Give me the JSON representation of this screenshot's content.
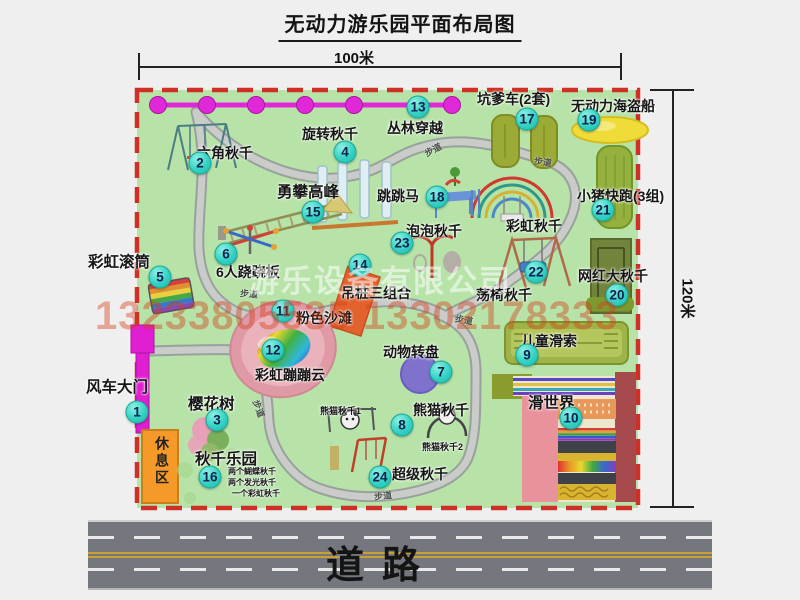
{
  "title": "无动力游乐园平面布局图",
  "dimensions": {
    "top": "100米",
    "right": "120米"
  },
  "watermark": {
    "company": "游乐设备有限公司",
    "phone": "13233805535 13302178333"
  },
  "road_label": "道路",
  "rest_area_label": "休息区",
  "path_label": "步道",
  "colors": {
    "map_green": "#b7e3a8",
    "dashed_border_red": "#cf3026",
    "badge_teal": "#34d2c4",
    "chain_magenta": "#e028d8",
    "gate_magenta": "#e01ed2",
    "rest_orange": "#f59a28",
    "road_gray": "#74777d",
    "watermark_red": "#d53e1a"
  },
  "attractions": [
    {
      "num": "1",
      "name": "风车大门"
    },
    {
      "num": "2",
      "name": "六角秋千"
    },
    {
      "num": "3",
      "name": "樱花树"
    },
    {
      "num": "4",
      "name": "旋转秋千"
    },
    {
      "num": "5",
      "name": "彩虹滚筒"
    },
    {
      "num": "6",
      "name": "6人跷跷板"
    },
    {
      "num": "7",
      "name": "动物转盘"
    },
    {
      "num": "8",
      "name": "熊猫秋千"
    },
    {
      "num": "9",
      "name": "儿童滑索"
    },
    {
      "num": "10",
      "name": "滑世界"
    },
    {
      "num": "11",
      "name": "粉色沙滩"
    },
    {
      "num": "12",
      "name": "彩虹蹦蹦云"
    },
    {
      "num": "13",
      "name": "丛林穿越"
    },
    {
      "num": "14",
      "name": "吊桩三组合"
    },
    {
      "num": "15",
      "name": "勇攀高峰"
    },
    {
      "num": "16",
      "name": "秋千乐园"
    },
    {
      "num": "17",
      "name": "坑爹车(2套)"
    },
    {
      "num": "18",
      "name": "跳跳马"
    },
    {
      "num": "19",
      "name": "无动力海盗船"
    },
    {
      "num": "20",
      "name": "网红大秋千"
    },
    {
      "num": "21",
      "name": "小猪快跑(3组)"
    },
    {
      "num": "22",
      "name": "荡椅秋千"
    },
    {
      "num": "23",
      "name": "泡泡秋千"
    },
    {
      "num": "24",
      "name": "超级秋千"
    }
  ],
  "extras": {
    "rainbow_swing": "彩虹秋千",
    "panda1": "熊猫秋千1",
    "panda2": "熊猫秋千2",
    "swing_lines": [
      "两个蝴蝶秋千",
      "两个发光秋千",
      "一个彩虹秋千"
    ]
  }
}
